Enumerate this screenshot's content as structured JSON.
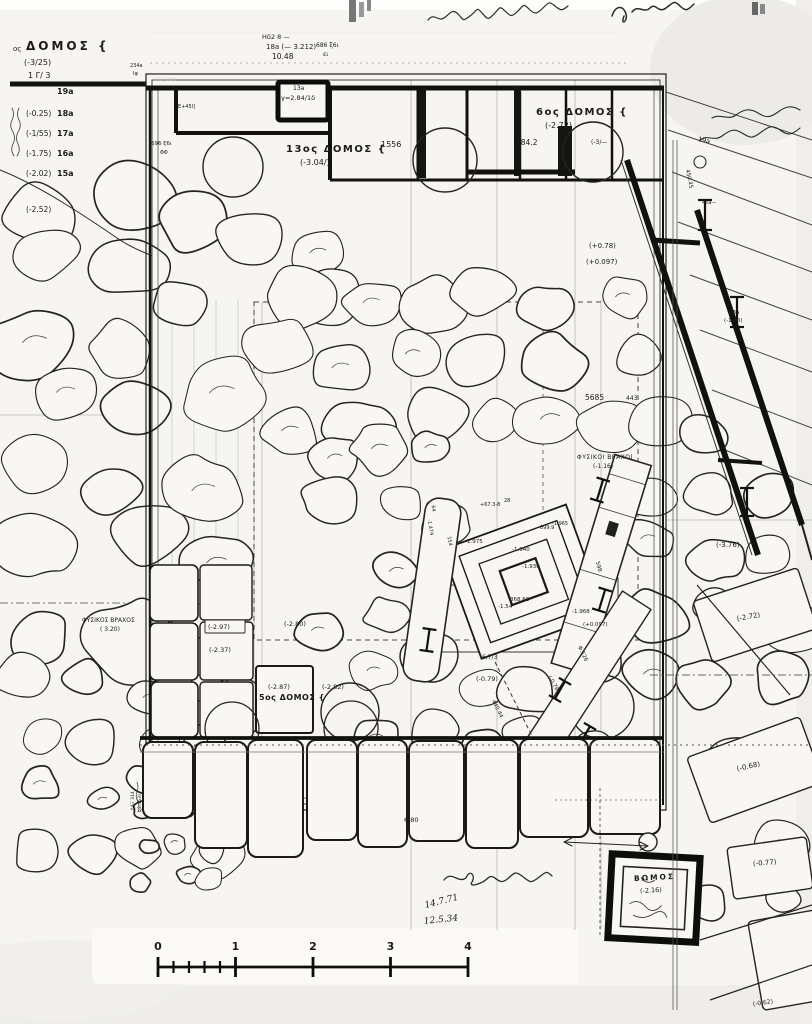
{
  "palette": {
    "paper": "#f6f5f2",
    "ink": "#1c1a17",
    "wall": "#111110",
    "stone_fill": "#f8f7f4"
  },
  "header_topleft": {
    "ordinal": "ος",
    "word": "ΔΟΜΟΣ {",
    "elevation": "(-3/25)",
    "note": "1 Γ/ 3"
  },
  "margin_list": {
    "rows": [
      {
        "elevation": "",
        "name": "19a"
      },
      {
        "elevation": "(-0.25)",
        "name": "18a"
      },
      {
        "elevation": "(-1/55)",
        "name": "17a"
      },
      {
        "elevation": "(-1.75)",
        "name": "16a"
      },
      {
        "elevation": "(-2.02)",
        "name": "15a"
      },
      {
        "elevation": "(-2.52)",
        "name": ""
      }
    ]
  },
  "plan_labels": [
    {
      "t": "ΙΓΛ.3669",
      "x": 154,
      "y": 80,
      "s": 5,
      "c": "#dddbd6"
    },
    {
      "t": "234a",
      "x": 130,
      "y": 66,
      "s": 5
    },
    {
      "t": "Ιφ",
      "x": 133,
      "y": 74,
      "s": 5
    },
    {
      "t": "[Ε+45Ι]",
      "x": 176,
      "y": 107,
      "s": 5
    },
    {
      "t": "696 ξ6ι",
      "x": 151,
      "y": 145,
      "s": 5.5
    },
    {
      "t": "ΦΦ",
      "x": 160,
      "y": 153,
      "s": 5
    },
    {
      "t": "Ηδ2 8 —",
      "x": 262,
      "y": 37,
      "s": 6.5
    },
    {
      "t": "18a (— 3.212)",
      "x": 266,
      "y": 47,
      "s": 7
    },
    {
      "t": "10.48",
      "x": 272,
      "y": 57,
      "s": 7.5
    },
    {
      "t": "686 ξ6ι",
      "x": 316,
      "y": 46,
      "s": 6
    },
    {
      "t": "ει",
      "x": 323,
      "y": 55,
      "s": 6
    },
    {
      "t": "13a",
      "x": 293,
      "y": 89,
      "s": 6
    },
    {
      "t": "γ=2.84/1δ",
      "x": 281,
      "y": 98,
      "s": 6.5
    },
    {
      "t": "13ος ΔΟΜΟΣ {",
      "x": 286,
      "y": 150,
      "s": 10,
      "ls": 1.5,
      "b": 1
    },
    {
      "t": "(-3.04/)",
      "x": 300,
      "y": 163,
      "s": 8
    },
    {
      "t": "1556",
      "x": 381,
      "y": 145,
      "s": 8
    },
    {
      "t": "6ος ΔΟΜΟΣ {",
      "x": 536,
      "y": 113,
      "s": 10,
      "ls": 1.5,
      "b": 1
    },
    {
      "t": "(-2.72)",
      "x": 545,
      "y": 126,
      "s": 8
    },
    {
      "t": "184.2",
      "x": 516,
      "y": 143,
      "s": 7.5
    },
    {
      "t": "(-3/—",
      "x": 591,
      "y": 143,
      "s": 6
    },
    {
      "t": "(+0.78)",
      "x": 589,
      "y": 246,
      "s": 7
    },
    {
      "t": "(+0.097)",
      "x": 586,
      "y": 262,
      "s": 7
    },
    {
      "t": "5685",
      "x": 585,
      "y": 398,
      "s": 7.5
    },
    {
      "t": "443",
      "x": 626,
      "y": 399,
      "s": 6
    },
    {
      "t": "ΦΥΣΙΚΟΙ ΒΡΑΧΟΙ",
      "x": 577,
      "y": 458,
      "s": 6,
      "ls": 0.5
    },
    {
      "t": "(-1.16)",
      "x": 593,
      "y": 467,
      "s": 6
    },
    {
      "t": "ΦΥΣΙΚΟΣ ΒΡΑΧΟΣ",
      "x": 82,
      "y": 621,
      "s": 6
    },
    {
      "t": "( 3.20)",
      "x": 100,
      "y": 630,
      "s": 6
    },
    {
      "t": "(-3.76)",
      "x": 716,
      "y": 545,
      "s": 7
    },
    {
      "t": "(-2.72)",
      "x": 737,
      "y": 619,
      "s": 7,
      "r": -10
    },
    {
      "t": "(-0.68)",
      "x": 737,
      "y": 769,
      "s": 7,
      "r": -12
    },
    {
      "t": "(-0.77)",
      "x": 753,
      "y": 864,
      "s": 7,
      "r": -5
    },
    {
      "t": "(-0.62)",
      "x": 753,
      "y": 1005,
      "s": 6,
      "r": -8
    },
    {
      "t": "19a",
      "x": 698,
      "y": 139,
      "s": 6.5,
      "r": 12
    },
    {
      "t": "450.45",
      "x": 686,
      "y": 170,
      "s": 5.5,
      "r": 78
    },
    {
      "t": "45a—",
      "x": 702,
      "y": 203,
      "s": 5
    },
    {
      "t": "13a",
      "x": 729,
      "y": 314,
      "s": 5.5
    },
    {
      "t": "(-1.40)",
      "x": 724,
      "y": 322,
      "s": 5.5
    },
    {
      "t": "ΒΩΜΟΣ",
      "x": 634,
      "y": 879,
      "s": 7.5,
      "r": -3,
      "ls": 2,
      "b": 1
    },
    {
      "t": "(-2.16)",
      "x": 640,
      "y": 891,
      "s": 6.5,
      "r": -3
    },
    {
      "t": "5ος ΔΟΜΟΣ {",
      "x": 259,
      "y": 698,
      "s": 8,
      "ls": 0.5,
      "b": 1
    },
    {
      "t": "(-2.87)",
      "x": 268,
      "y": 687,
      "s": 6.5
    },
    {
      "t": "(-2.82)",
      "x": 322,
      "y": 687,
      "s": 6.5
    },
    {
      "t": "(-2.80)",
      "x": 284,
      "y": 624,
      "s": 6.5
    },
    {
      "t": "(-2.97)",
      "x": 208,
      "y": 627,
      "s": 6.5
    },
    {
      "t": "(-2.37)",
      "x": 209,
      "y": 650,
      "s": 6.5
    },
    {
      "t": "(-0.79)",
      "x": 476,
      "y": 679,
      "s": 6.5
    },
    {
      "t": "6,7/3",
      "x": 482,
      "y": 658,
      "s": 6
    },
    {
      "t": "6.80",
      "x": 404,
      "y": 820,
      "s": 6.5
    },
    {
      "t": "14.7.71",
      "x": 425,
      "y": 906,
      "s": 9,
      "r": -14,
      "f": "hand"
    },
    {
      "t": "12.5.34",
      "x": 424,
      "y": 922,
      "s": 9,
      "r": -6,
      "f": "hand"
    },
    {
      "t": "(-0.78)",
      "x": 548,
      "y": 677,
      "s": 5.5,
      "r": 60
    },
    {
      "t": "440.44",
      "x": 492,
      "y": 701,
      "s": 5.5,
      "r": 64
    },
    {
      "t": "Φ.126",
      "x": 578,
      "y": 647,
      "s": 5.5,
      "r": 64
    },
    {
      "t": "64",
      "x": 432,
      "y": 505,
      "s": 5,
      "r": 80
    },
    {
      "t": "-1.474",
      "x": 428,
      "y": 519,
      "s": 5,
      "r": 80
    },
    {
      "t": "154",
      "x": 448,
      "y": 536,
      "s": 5,
      "r": 80
    },
    {
      "t": "-1.975",
      "x": 465,
      "y": 543,
      "s": 5.5
    },
    {
      "t": "+67.3-8",
      "x": 480,
      "y": 505,
      "s": 5
    },
    {
      "t": "28",
      "x": 504,
      "y": 501,
      "s": 5
    },
    {
      "t": "899.9",
      "x": 540,
      "y": 528,
      "s": 5
    },
    {
      "t": "-1.965",
      "x": 552,
      "y": 524,
      "s": 5
    },
    {
      "t": "-1.940",
      "x": 512,
      "y": 551,
      "s": 5.5
    },
    {
      "t": "-1.930",
      "x": 522,
      "y": 568,
      "s": 5.5
    },
    {
      "t": "368.68",
      "x": 510,
      "y": 601,
      "s": 5.5
    },
    {
      "t": "-1.54",
      "x": 498,
      "y": 608,
      "s": 5.5
    },
    {
      "t": "598",
      "x": 596,
      "y": 562,
      "s": 5.5,
      "r": 75
    },
    {
      "t": "-1.968",
      "x": 572,
      "y": 613,
      "s": 5.5
    },
    {
      "t": "(+0.097)",
      "x": 583,
      "y": 626,
      "s": 5.5
    },
    {
      "t": "(-2.453)",
      "x": 141,
      "y": 812,
      "s": 4.5,
      "r": -90
    },
    {
      "t": "ΛΑΞ 314",
      "x": 134,
      "y": 810,
      "s": 4.5,
      "r": -90
    }
  ],
  "scale_bar": {
    "tick_labels": [
      "0",
      "1",
      "2",
      "3",
      "4"
    ],
    "minor_divisions_first_unit": 5
  },
  "dates": [
    "14.7.71",
    "12.5.34"
  ]
}
